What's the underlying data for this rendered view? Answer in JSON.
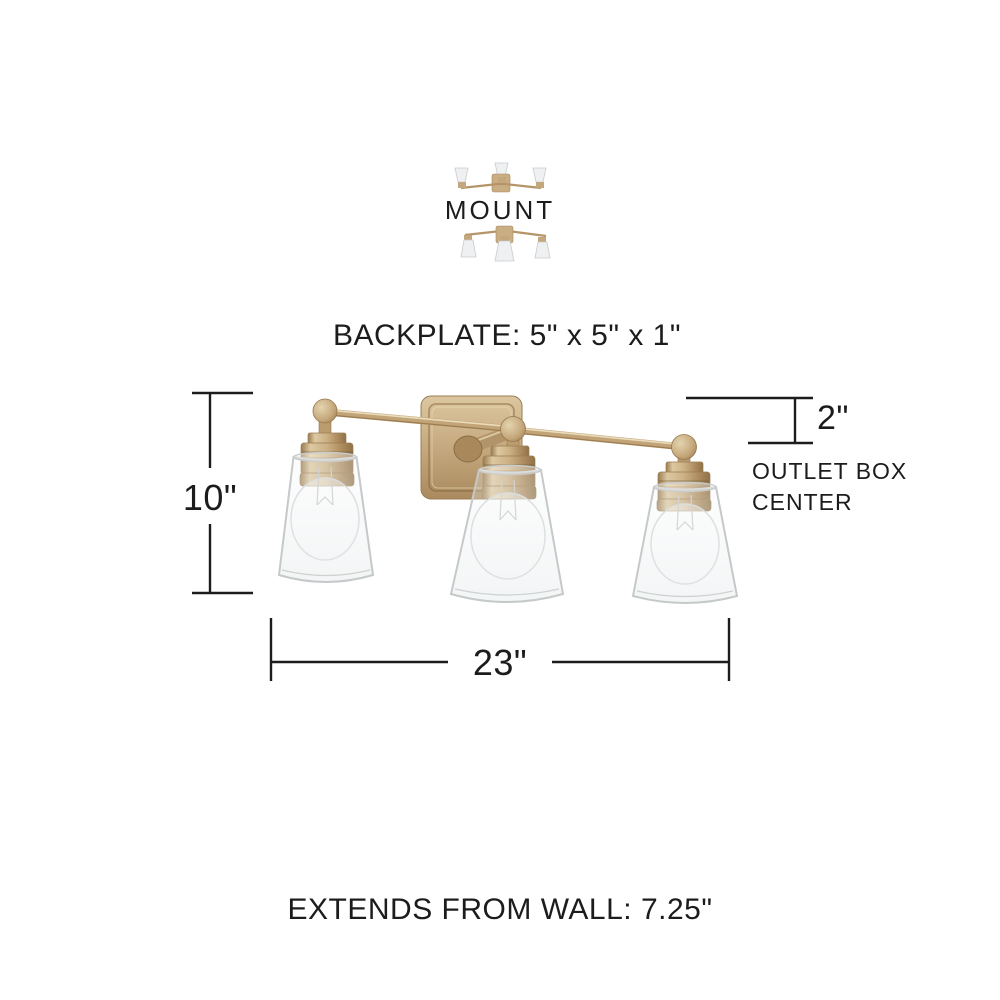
{
  "page": {
    "background": "#ffffff",
    "text_color": "#1c1c1c"
  },
  "mount_section": {
    "label": "MOUNT"
  },
  "backplate": {
    "label": "BACKPLATE: 5\" x 5\" x 1\""
  },
  "dimensions": {
    "height_label": "10\"",
    "width_label": "23\"",
    "outlet_offset_label": "2\"",
    "outlet_box_line1": "OUTLET BOX",
    "outlet_box_line2": "CENTER",
    "extends_label": "EXTENDS FROM WALL: 7.25\""
  },
  "colors": {
    "brass": "#c2a478",
    "brass_light": "#e6d6b4",
    "brass_dark": "#8f7248",
    "glass_outline": "#c6c9c9",
    "dimension_line": "#1c1c1c"
  }
}
